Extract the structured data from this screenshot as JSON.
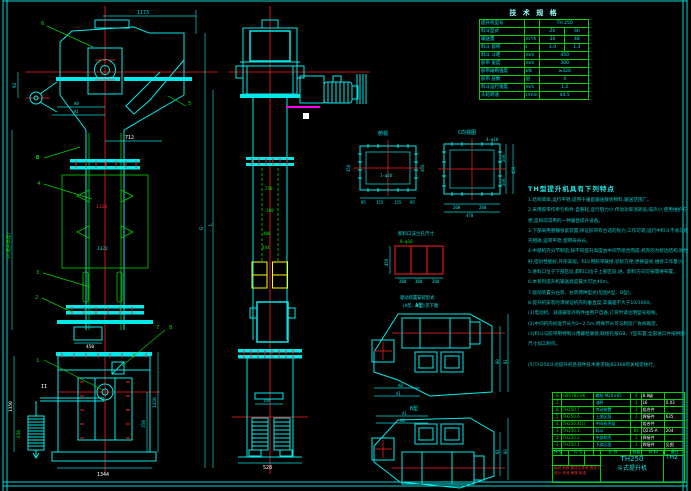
{
  "spec": {
    "title": "技 术 规 格",
    "rows": [
      {
        "l": "提升机型号",
        "u": "",
        "v": "TH 250"
      },
      {
        "l": "料斗型式",
        "u": "",
        "v1": "Zh",
        "v2": "Sh"
      },
      {
        "l": "输送量",
        "u": "m³/h",
        "v1": "30",
        "v2": "48"
      },
      {
        "l": "料斗 容积",
        "u": "l",
        "v1": "3.0",
        "v2": "1.3"
      },
      {
        "l": "料斗 斗距",
        "u": "mm",
        "v": "450"
      },
      {
        "l": "胶带 宽度",
        "u": "mm",
        "v": "300"
      },
      {
        "l": "胶带破断强度",
        "u": "kN",
        "v": "≥320"
      },
      {
        "l": "胶带 层数",
        "u": "层",
        "v": "4"
      },
      {
        "l": "料斗运行速度",
        "u": "m/s",
        "v": "1.2"
      },
      {
        "l": "头轮转速",
        "u": "r/min",
        "v": "44.5"
      }
    ]
  },
  "features": {
    "title": "TH型提升机具有下列特点",
    "body": "1.结构简单,运行平稳,适用于垂直输送散状物料,输送范围广。\n2.采用胶带作牵引构件,自重轻,运行阻力小,传动功率消耗低,噪声小,使用维护方便,是目前常用的一种垂直提升设备。\n3.下部采用重锤张紧装置,保证胶带有合适的张力,工作可靠,运行中料斗不易与机壳相碰,运转平稳,使用寿命长。\n4.中部机壳分节制造,按不同提升高度由中间节组合而成,机壳均为折边结构,刚性好,密封性能好,外形美观。料斗用胶带联接,装拆方便,更换容易,维修工作量小。\n5.进料口位于下部区段,卸料口位于上部区段,进、卸料方向可按需要布置。\n6.本系列提升机输送高度最大可达40m。\n7.驱动装置分左装、右装两种型式(见图A型、B型)。\n8.提升机安装时须保证机壳的垂直度,其偏差不大于10/1000。\n(1)电动机、减速器等外购件由用户自备,订货时请注明型号规格。\n(2)中间机壳标准节长为2~2.5m,特殊节长可与制造厂协商确定。\n(3)料斗与胶带用特制斗用螺栓联接,联接孔按GB、Y型布置,全部进口件按供图尺寸加工制作。\n\n(5)TH250斗式提升机各部件技术要求按JB2268有关规定执行。"
  },
  "bom": {
    "headers": [
      "序号",
      "代 号",
      "名 称",
      "数量",
      "材 料",
      "备注"
    ],
    "rows": [
      {
        "no": "8",
        "code": "GB5782-86",
        "name": "螺栓 M20×65",
        "qty": "4",
        "mat": "8.8级",
        "note": ""
      },
      {
        "no": "7",
        "code": "",
        "name": "油杯",
        "qty": "1",
        "mat": "L6",
        "note": "0.03"
      },
      {
        "no": "6",
        "code": "TH250.7",
        "name": "传动装置",
        "qty": "1",
        "mat": "组合件",
        "note": ""
      },
      {
        "no": "5",
        "code": "TH250.6",
        "name": "上部区段",
        "qty": "1",
        "mat": "焊接件",
        "note": "635"
      },
      {
        "no": "4",
        "code": "TH250.4(1)",
        "name": "中间机壳组",
        "qty": "",
        "mat": "组合件",
        "note": ""
      },
      {
        "no": "3",
        "code": "TH250.3",
        "name": "料斗",
        "qty": "84",
        "mat": "Q235-A",
        "note": "204"
      },
      {
        "no": "2",
        "code": "TH250.2",
        "name": "中部机壳",
        "qty": "1",
        "mat": "焊接件",
        "note": ""
      },
      {
        "no": "1",
        "code": "TH250.1",
        "name": "下部区段",
        "qty": "1",
        "mat": "焊接件",
        "note": "见图"
      }
    ]
  },
  "title_block": {
    "model": "TH250",
    "name": "斗式提升机",
    "drawing_no": "TH2",
    "sig1": "标记 处数 更改文件号 签字 日期",
    "sig2": "设计 校对 审核 批准"
  },
  "annotations": {
    "a_1173": "1173",
    "a_712": "712",
    "a_92": "92",
    "a_a0": "A0",
    "a_a1": "A1",
    "a_l6": "6",
    "a_l5": "5",
    "a_l4": "4",
    "a_l3": "3",
    "a_l2": "2",
    "a_l1": "1",
    "a_l7": "7",
    "a_l8": "8",
    "a_b": "B",
    "a_ii": "II",
    "a_1130": "1130",
    "a_1322": "1322",
    "a_h": "H(提升高度)",
    "a_g": "G",
    "a_l": "L",
    "a_450": "450",
    "a_1450": "1450",
    "a_350": "350",
    "a_1350": "1350",
    "a_650": "650",
    "a_1344": "1344",
    "a_144": "144",
    "a_528": "528",
    "a_250": "250",
    "a_180": "180",
    "a_400": "400",
    "a_444": "444",
    "f1_label": "俯视",
    "f1_350": "350",
    "f1_300": "300",
    "f1_95a": "95",
    "f1_155a": "155",
    "f1_155b": "155",
    "f1_95b": "95",
    "f1_hole": "1-φ20",
    "f2_label": "C向视图",
    "f2_holes": "4-φ18",
    "f2_200a": "200",
    "f2_200b": "200",
    "f2_450": "450",
    "f2_200c": "200",
    "f2_200d": "200",
    "f2_470": "470",
    "g_title": "卸料口法兰孔尺寸",
    "g_holes": "8-φ18",
    "g_450": "450",
    "g_200a": "200",
    "g_300": "300",
    "g_200b": "200",
    "n_line1": "驱动装置安装型式",
    "n_line2": "(A型、B型)见下图",
    "dA_label": "A型",
    "dA_a0": "A0",
    "dA_a1": "A1",
    "dA_b0": "B0",
    "dA_b1": "B1",
    "dB_label": "B型",
    "dB_a0": "A0",
    "dB_a1": "A1",
    "dB_b0": "B0",
    "dB_b1": "B1"
  }
}
